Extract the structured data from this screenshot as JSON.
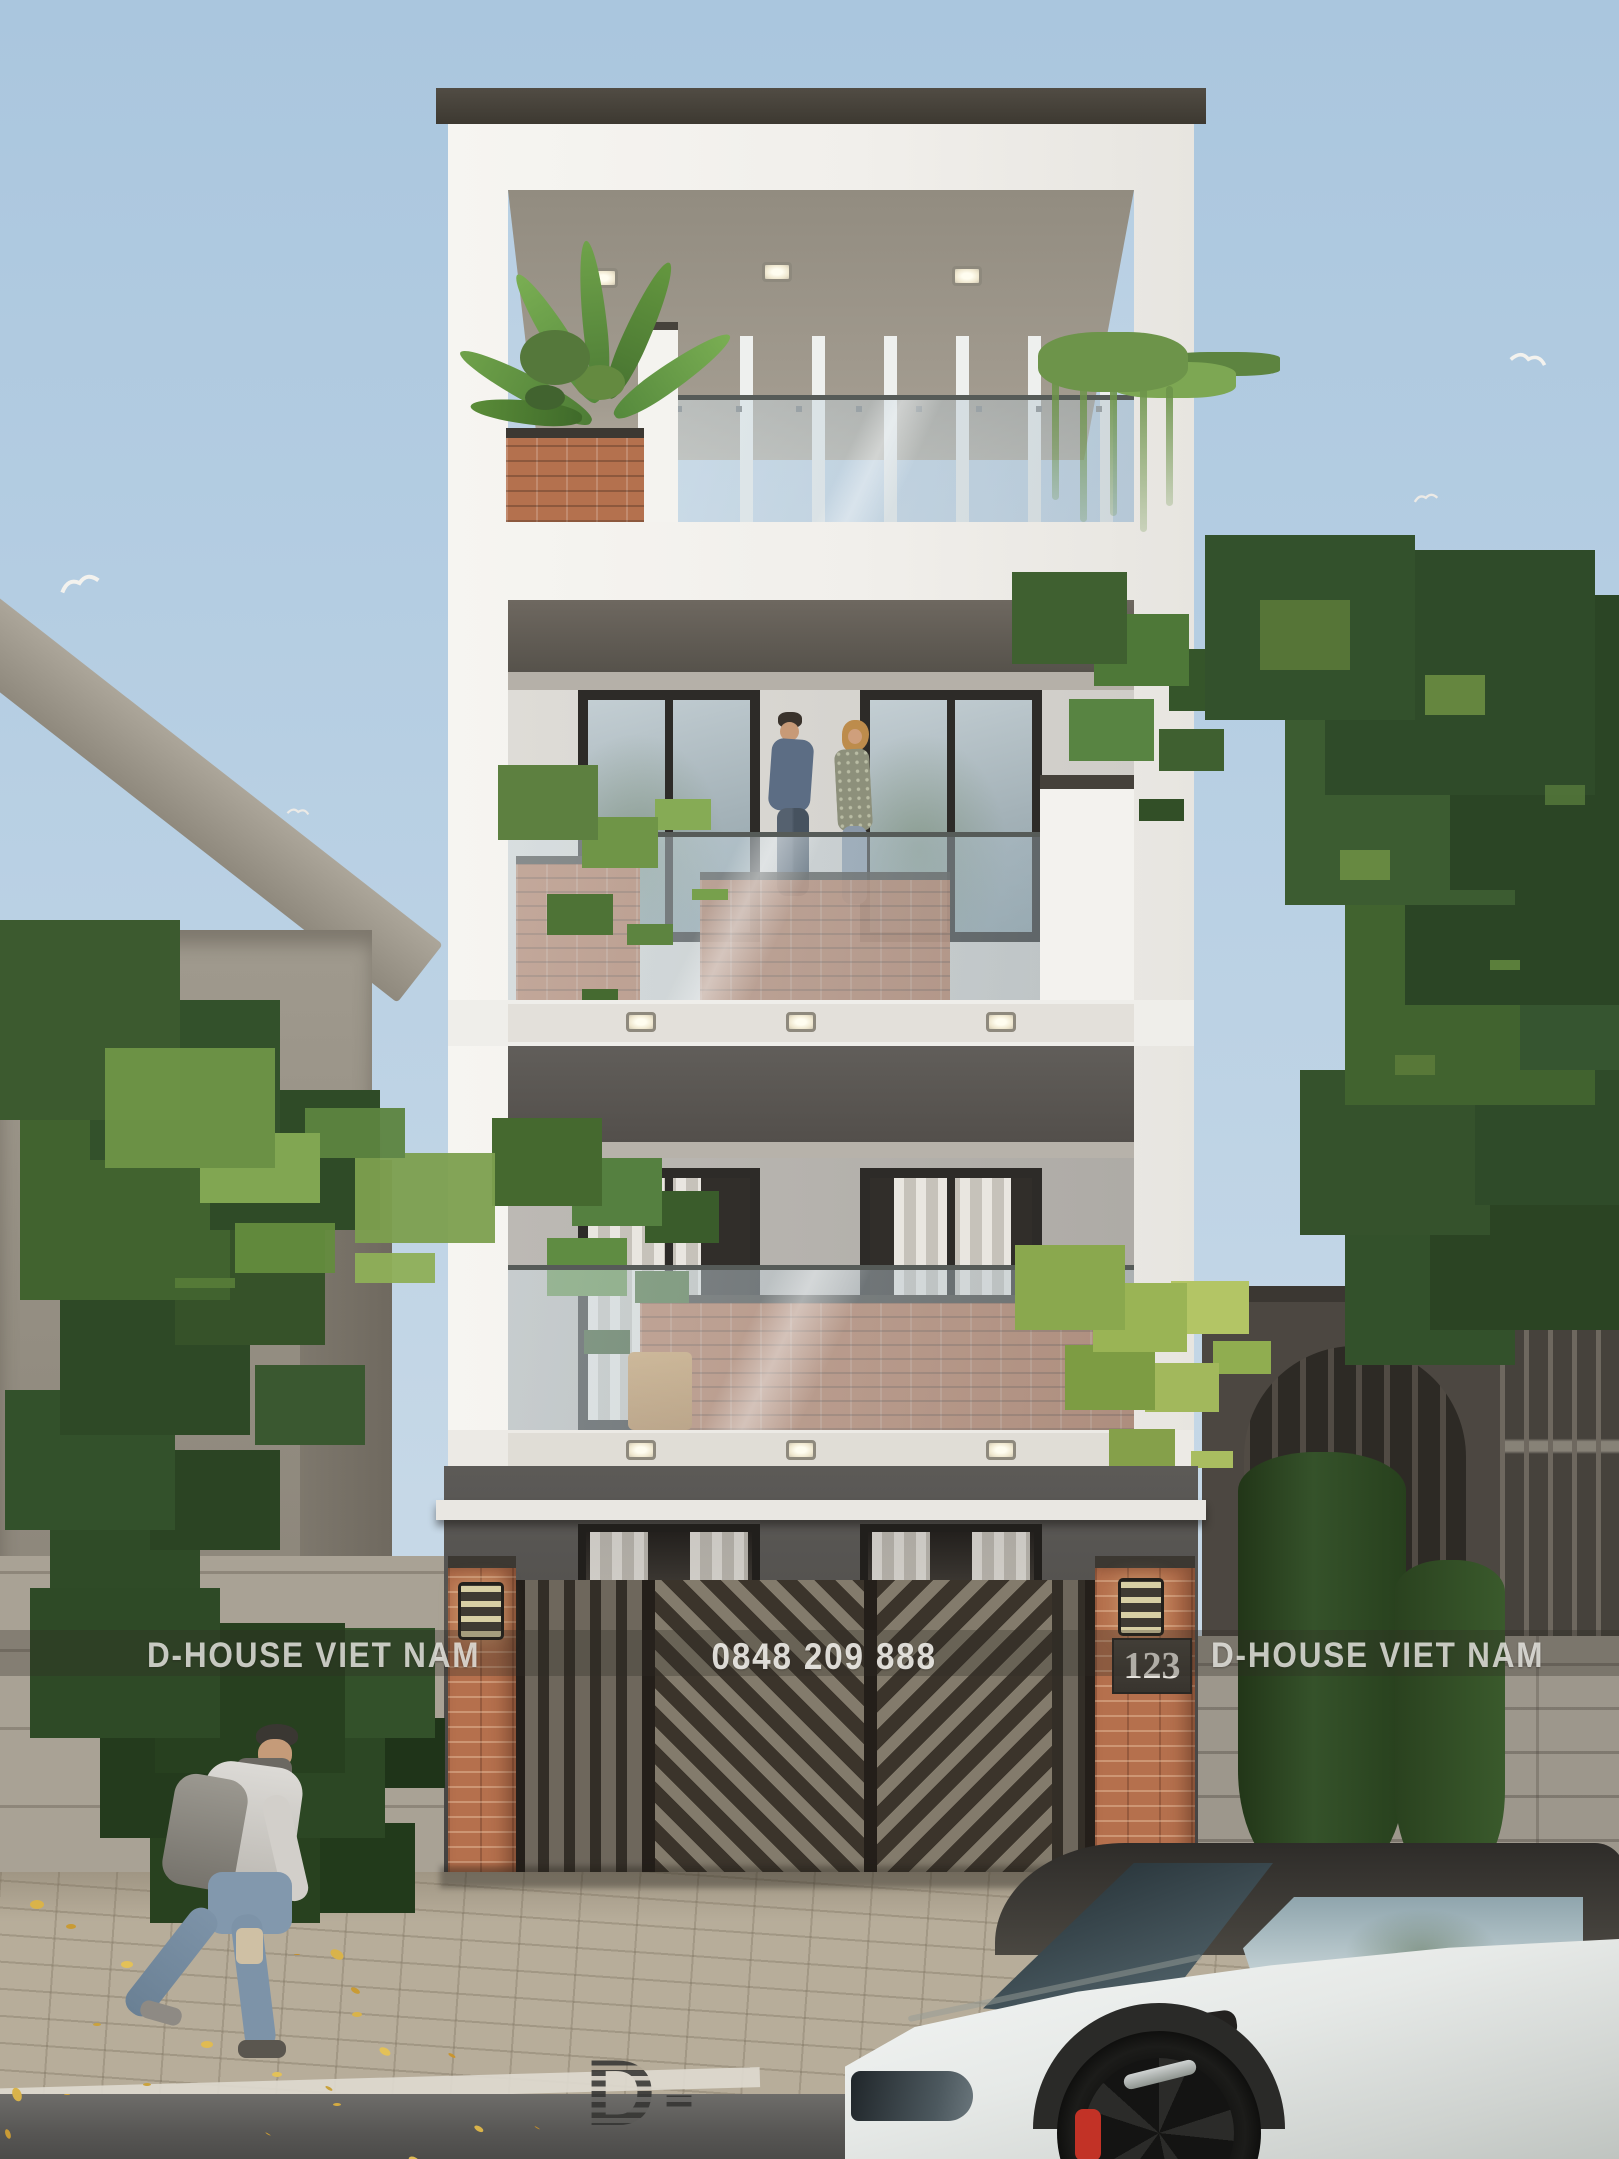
{
  "watermark": {
    "left": "D-HOUSE VIET NAM",
    "right": "D-HOUSE VIET NAM",
    "phone": "0848 209 888",
    "logo": "D-HOUSE"
  },
  "house": {
    "number": "123"
  },
  "colors": {
    "sky": "#b5cde2",
    "facade_white": "#f1efeb",
    "brick": "#b4714e",
    "dark_wall": "#4e4c49",
    "foliage": "#3c5a2f",
    "car_caliper_red": "#c23226",
    "watermark_text": "#f4f3ee"
  }
}
